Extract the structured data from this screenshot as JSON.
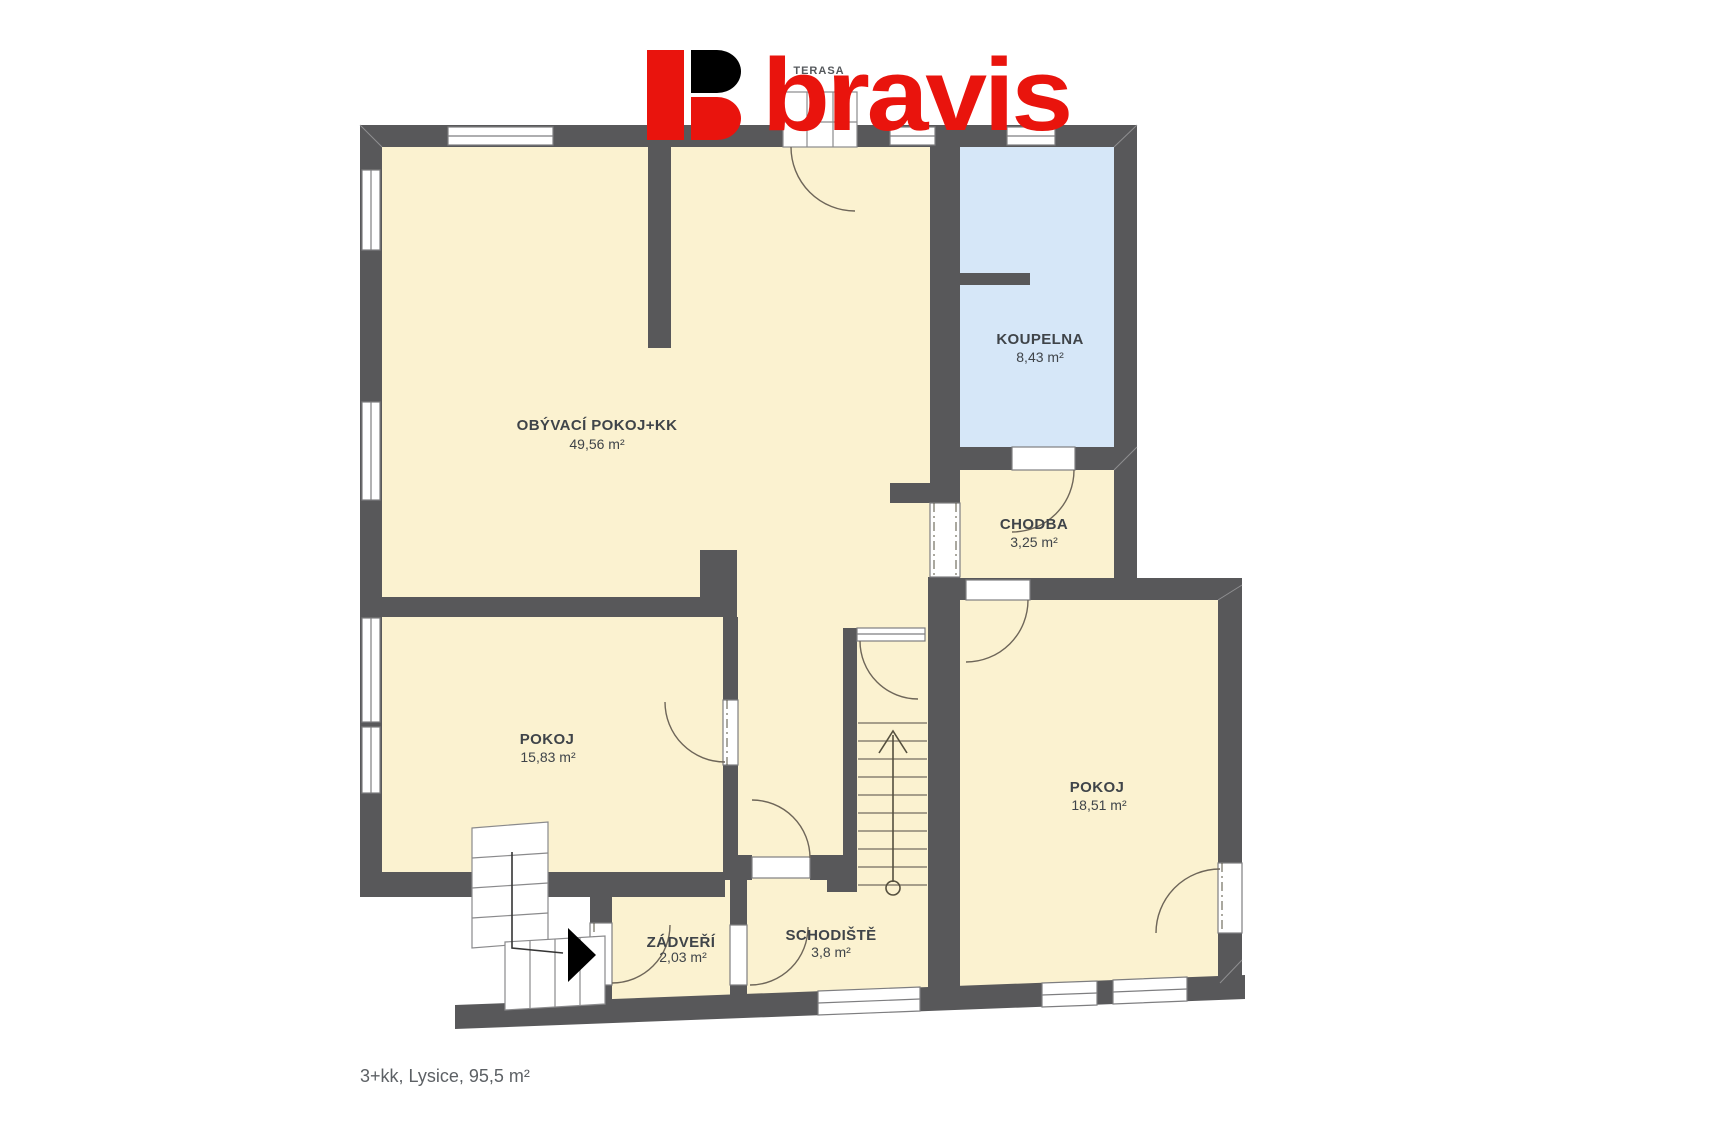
{
  "logo": {
    "brand": "bravis"
  },
  "terrace": {
    "label": "TERASA"
  },
  "rooms": [
    {
      "name": "OBÝVACÍ POKOJ+KK",
      "area": "49,56 m²"
    },
    {
      "name": "KOUPELNA",
      "area": "8,43 m²"
    },
    {
      "name": "CHODBA",
      "area": "3,25 m²"
    },
    {
      "name": "POKOJ",
      "area": "15,83 m²"
    },
    {
      "name": "POKOJ",
      "area": "18,51 m²"
    },
    {
      "name": "ZÁDVEŘÍ",
      "area": "2,03 m²"
    },
    {
      "name": "SCHODIŠTĚ",
      "area": "3,8 m²"
    }
  ],
  "caption": "3+kk, Lysice, 95,5 m²",
  "colors": {
    "brand_red": "#e9140d",
    "wall": "#58585a",
    "room_fill": "#fbf2d0",
    "bath_fill": "#d6e7f8",
    "label_text": "#3f4449",
    "caption_text": "#5d6165"
  }
}
